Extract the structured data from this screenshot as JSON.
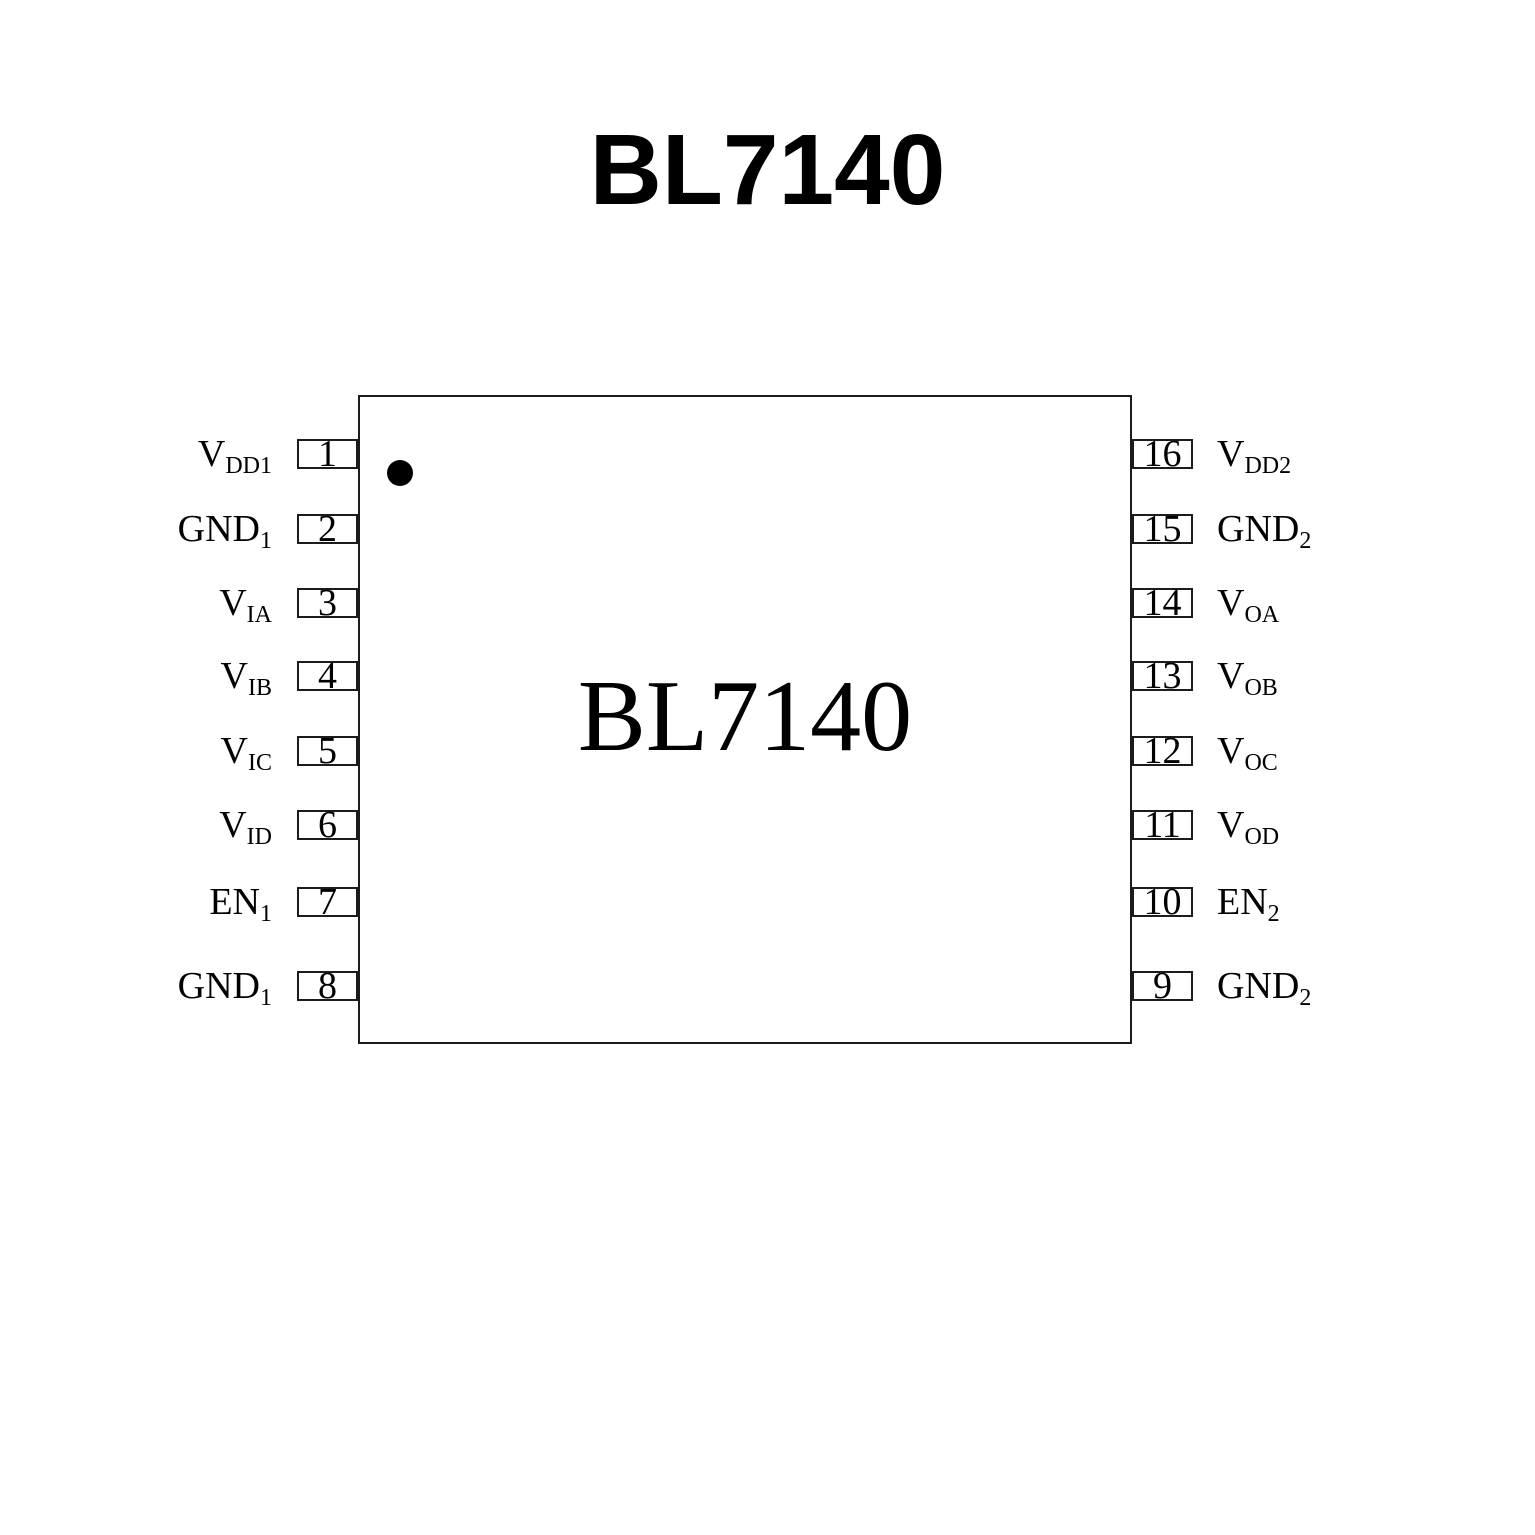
{
  "page_title": "BL7140",
  "chip": {
    "label": "BL7140",
    "pin1_marker_icon": "filled-circle-pin1-indicator"
  },
  "colors": {
    "ink": "#000000",
    "background": "#ffffff",
    "line": "#1c1c1c"
  },
  "pins": {
    "left": [
      {
        "number": "1",
        "base": "V",
        "sub": "DD1"
      },
      {
        "number": "2",
        "base": "GND",
        "sub": "1"
      },
      {
        "number": "3",
        "base": "V",
        "sub": "IA"
      },
      {
        "number": "4",
        "base": "V",
        "sub": "IB"
      },
      {
        "number": "5",
        "base": "V",
        "sub": "IC"
      },
      {
        "number": "6",
        "base": "V",
        "sub": "ID"
      },
      {
        "number": "7",
        "base": "EN",
        "sub": "1"
      },
      {
        "number": "8",
        "base": "GND",
        "sub": "1"
      }
    ],
    "right": [
      {
        "number": "16",
        "base": "V",
        "sub": "DD2"
      },
      {
        "number": "15",
        "base": "GND",
        "sub": "2"
      },
      {
        "number": "14",
        "base": "V",
        "sub": "OA"
      },
      {
        "number": "13",
        "base": "V",
        "sub": "OB"
      },
      {
        "number": "12",
        "base": "V",
        "sub": "OC"
      },
      {
        "number": "11",
        "base": "V",
        "sub": "OD"
      },
      {
        "number": "10",
        "base": "EN",
        "sub": "2"
      },
      {
        "number": "9",
        "base": "GND",
        "sub": "2"
      }
    ]
  }
}
